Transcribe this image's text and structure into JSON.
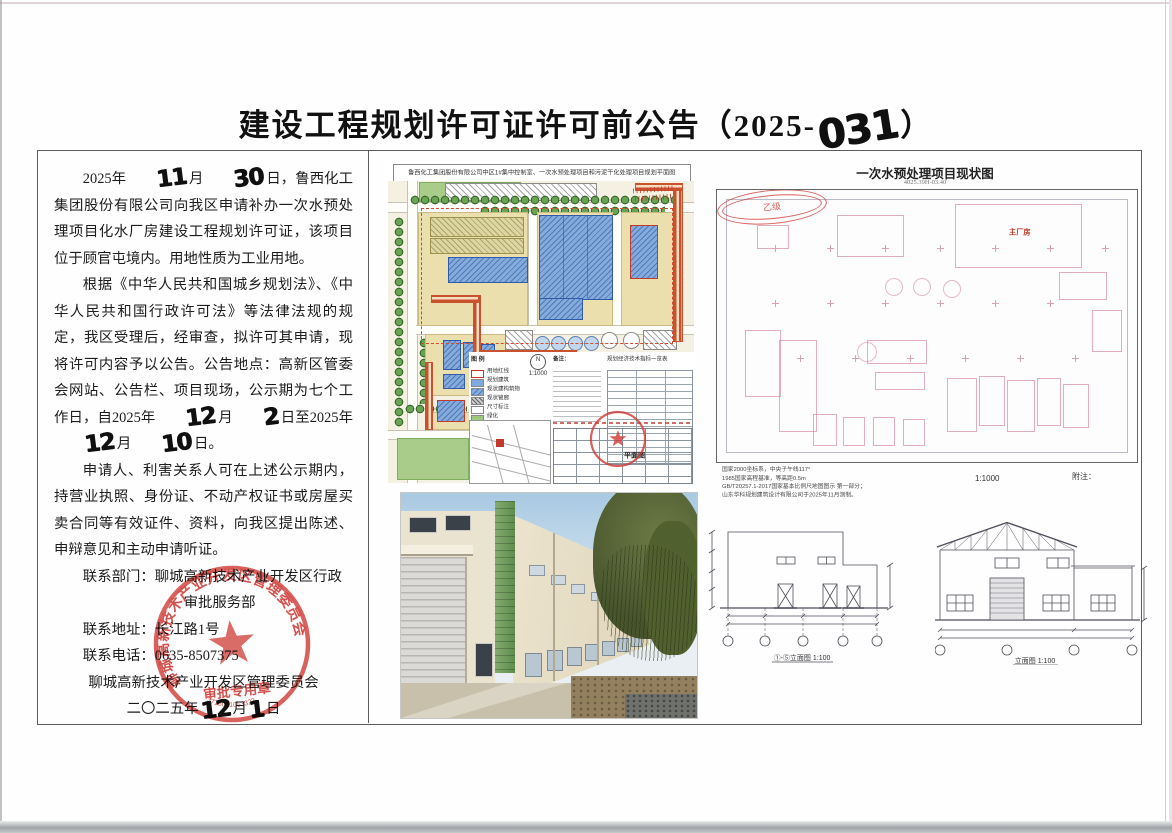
{
  "title": {
    "prefix": "建设工程规划许可证许可前公告（2025-",
    "number": "031",
    "suffix": "）"
  },
  "notice": {
    "p1": {
      "a": "2025年",
      "d1": "11",
      "b": "月",
      "d2": "30",
      "c": "日，鲁西化工集团股份有限公司向我区申请补办一次水预处理项目化水厂房建设工程规划许可证，该项目位于顾官屯境内。用地性质为工业用地。"
    },
    "p2": {
      "a": "根据《中华人民共和国城乡规划法》、《中华人民共和国行政许可法》等法律法规的规定，我区受理后，经审查，拟许可其申请，现将许可内容予以公告。公告地点：高新区管委会网站、公告栏、项目现场，公示期为七个工作日，自2025年",
      "d1": "12",
      "b": "月",
      "d2": "2",
      "c": "日至2025年",
      "d3": "12",
      "d": "月",
      "d4": "10",
      "e": "日。"
    },
    "p3": "申请人、利害关系人可在上述公示期内，持营业执照、身份证、不动产权证书或房屋买卖合同等有效证件、资料，向我区提出陈述、申辩意见和主动申请听证。",
    "contact_dept1": "联系部门：聊城高新技术产业开发区行政",
    "contact_dept2": "审批服务部",
    "contact_addr": "联系地址：长江路1号",
    "contact_tel": "联系电话：0635-8507375",
    "sig_org": "聊城高新技术产业开发区管理委员会",
    "date": {
      "a": "二〇二五年",
      "d1": "12",
      "b": "月",
      "d2": "1",
      "c": "日"
    }
  },
  "seal": {
    "ring": "聊城高新技术产业开发区管理委员会",
    "bottom": "审批专用章",
    "number": "3715001053322"
  },
  "siteplan": {
    "title": "鲁西化工集团股份有限公司中区1#集中控制室、一次水预处理项目和污泥干化处理项目规划平面图",
    "legend_title": "图 例",
    "legend": [
      "用地红线",
      "规划建筑",
      "现状建构筑物",
      "现状管廊",
      "尺寸标注",
      "绿化"
    ],
    "north": "N",
    "scale": "1:1000",
    "notes_title": "备注：",
    "table_title": "规划经济技术指标一览表",
    "plan_label": "平面图"
  },
  "statusmap": {
    "title": "一次水预处理项目现状图",
    "subtitle": "4025.39H-03.40",
    "building_label": "主厂房",
    "scale": "1:1000",
    "annex_label": "附注：",
    "notes": [
      "国家2000坐标系，中央子午线117°",
      "1985国家高程基准，等高距0.5m",
      "GB/T20257.1-2017国家基本比例尺地图图示 第一部分；",
      "山东华科规划建筑设计有限公司于2025年11月测制。"
    ],
    "seal_grade": "乙级"
  },
  "elevations": {
    "left_label": "①-⑤立面图 1:100",
    "right_label": "立面图 1:100"
  }
}
